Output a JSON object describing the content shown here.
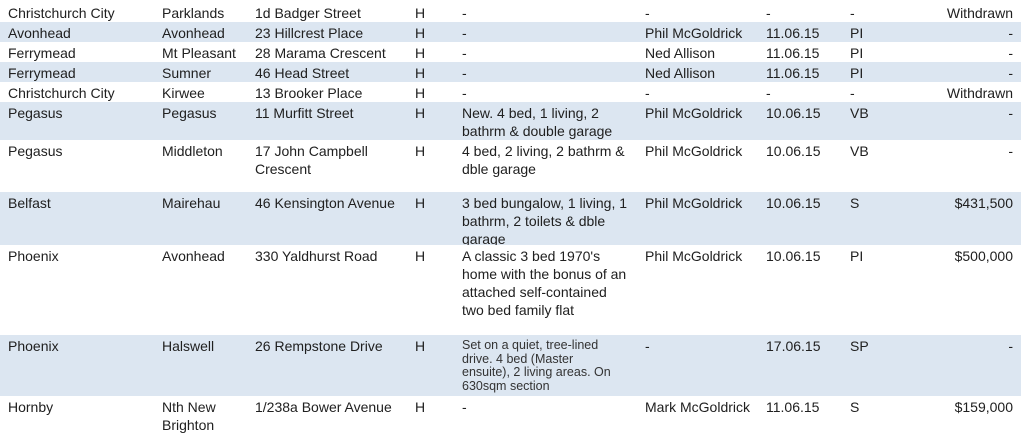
{
  "colors": {
    "band_blue": "#dce6f1",
    "row_white": "#ffffff",
    "text": "#202020"
  },
  "table": {
    "column_keys": [
      "area",
      "suburb",
      "address",
      "property_type",
      "description",
      "agent",
      "date",
      "status_code",
      "result"
    ],
    "rows": [
      {
        "area": "Christchurch City",
        "suburb": "Parklands",
        "address": "1d Badger Street",
        "property_type": "H",
        "description": "-",
        "agent": "-",
        "date": "-",
        "status_code": "-",
        "result": "Withdrawn"
      },
      {
        "area": "Avonhead",
        "suburb": "Avonhead",
        "address": "23 Hillcrest Place",
        "property_type": "H",
        "description": "-",
        "agent": "Phil McGoldrick",
        "date": "11.06.15",
        "status_code": "PI",
        "result": "-"
      },
      {
        "area": "Ferrymead",
        "suburb": "Mt Pleasant",
        "address": "28 Marama Crescent",
        "property_type": "H",
        "description": "-",
        "agent": "Ned Allison",
        "date": "11.06.15",
        "status_code": "PI",
        "result": "-"
      },
      {
        "area": "Ferrymead",
        "suburb": "Sumner",
        "address": "46 Head Street",
        "property_type": "H",
        "description": "-",
        "agent": "Ned Allison",
        "date": "11.06.15",
        "status_code": "PI",
        "result": "-"
      },
      {
        "area": "Christchurch City",
        "suburb": "Kirwee",
        "address": "13 Brooker Place",
        "property_type": "H",
        "description": "-",
        "agent": "-",
        "date": "-",
        "status_code": "-",
        "result": "Withdrawn"
      },
      {
        "area": "Pegasus",
        "suburb": "Pegasus",
        "address": "11 Murfitt Street",
        "property_type": "H",
        "description": "New. 4 bed, 1 living, 2 bathrm & double garage",
        "agent": "Phil McGoldrick",
        "date": "10.06.15",
        "status_code": "VB",
        "result": "-"
      },
      {
        "area": "Pegasus",
        "suburb": "Middleton",
        "address": "17 John Campbell Crescent",
        "property_type": "H",
        "description": "4 bed, 2 living, 2 bathrm & dble garage",
        "agent": "Phil McGoldrick",
        "date": "10.06.15",
        "status_code": "VB",
        "result": "-"
      },
      {
        "area": "Belfast",
        "suburb": "Mairehau",
        "address": "46 Kensington Avenue",
        "property_type": "H",
        "description": "3 bed bungalow, 1 living, 1 bathrm, 2 toilets & dble garage",
        "agent": "Phil McGoldrick",
        "date": "10.06.15",
        "status_code": "S",
        "result": "$431,500"
      },
      {
        "area": "Phoenix",
        "suburb": "Avonhead",
        "address": "330 Yaldhurst Road",
        "property_type": "H",
        "description": "A classic 3 bed 1970's home with the bonus of an attached self-contained two bed family flat",
        "agent": "Phil McGoldrick",
        "date": "10.06.15",
        "status_code": "PI",
        "result": "$500,000"
      },
      {
        "area": "Phoenix",
        "suburb": "Halswell",
        "address": "26 Rempstone Drive",
        "property_type": "H",
        "description": "Set on a quiet, tree-lined drive. 4 bed (Master ensuite), 2 living areas. On 630sqm section",
        "agent": "-",
        "date": "17.06.15",
        "status_code": "SP",
        "result": "-"
      },
      {
        "area": "Hornby",
        "suburb": "Nth New Brighton",
        "address": "1/238a Bower Avenue",
        "property_type": "H",
        "description": "-",
        "agent": "Mark McGoldrick",
        "date": "11.06.15",
        "status_code": "S",
        "result": "$159,000"
      }
    ]
  }
}
